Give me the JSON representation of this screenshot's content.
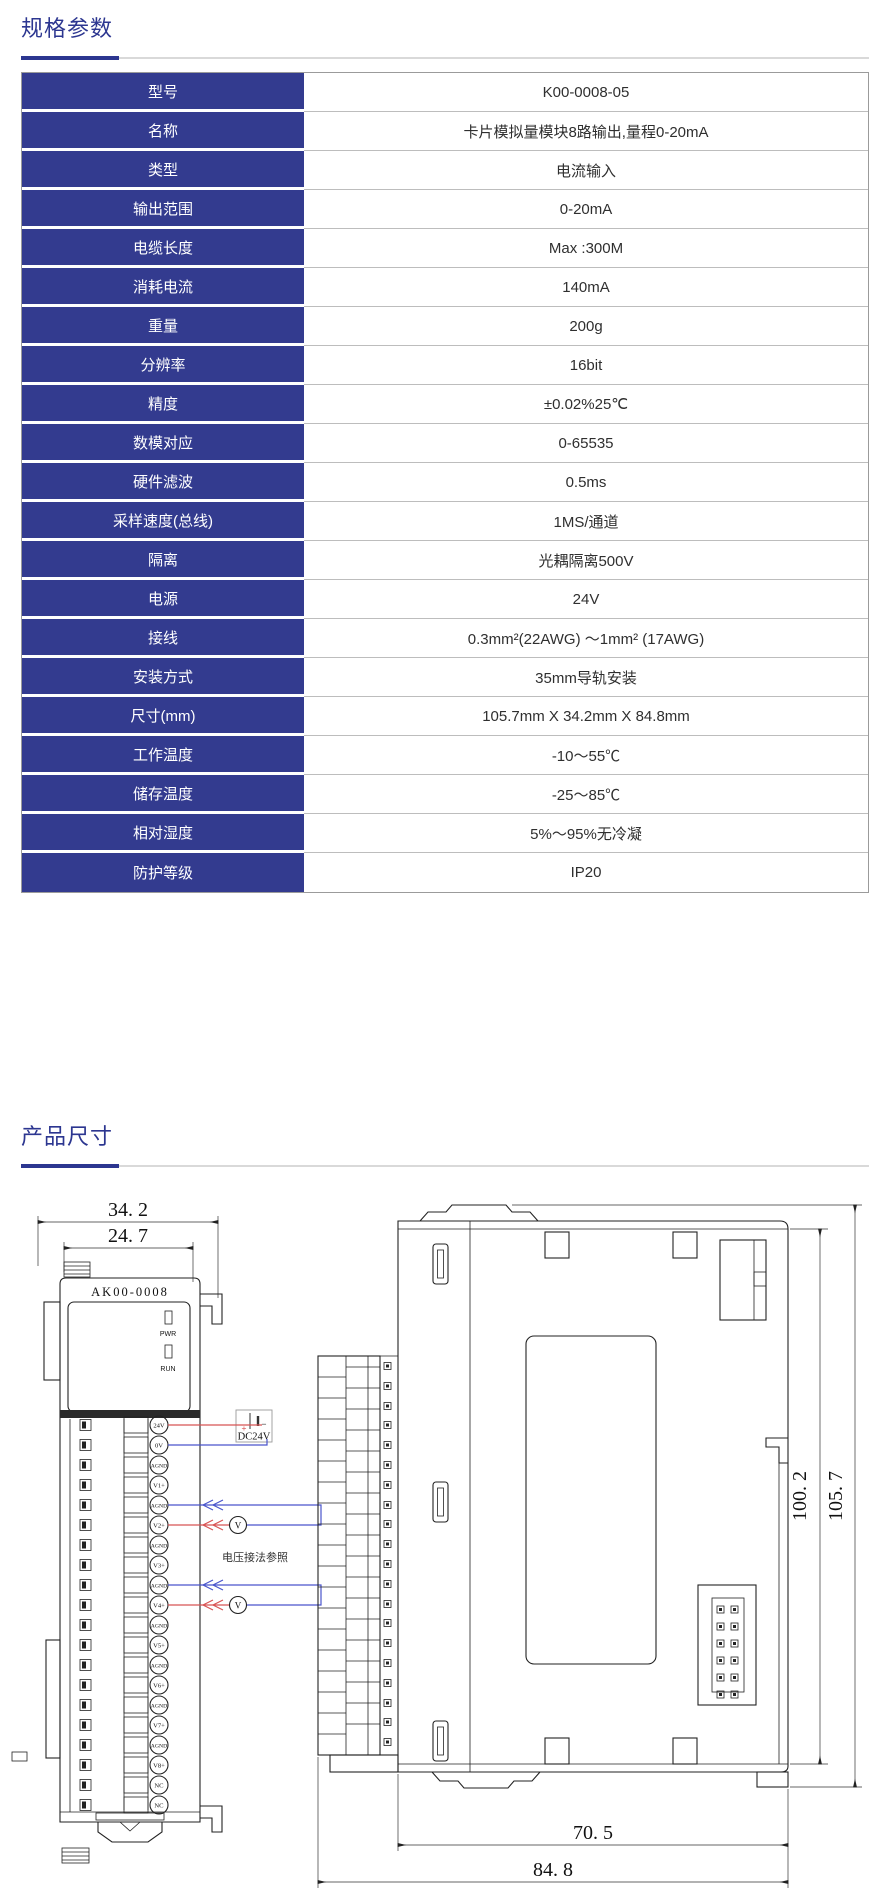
{
  "specs": {
    "title": "规格参数",
    "rows": [
      {
        "label": "型号",
        "value": "K00-0008-05"
      },
      {
        "label": "名称",
        "value": "卡片模拟量模块8路输出,量程0-20mA"
      },
      {
        "label": "类型",
        "value": "电流输入"
      },
      {
        "label": "输出范围",
        "value": "0-20mA"
      },
      {
        "label": "电缆长度",
        "value": "Max :300M"
      },
      {
        "label": "消耗电流",
        "value": "140mA"
      },
      {
        "label": "重量",
        "value": "200g"
      },
      {
        "label": "分辨率",
        "value": "16bit"
      },
      {
        "label": "精度",
        "value": "±0.02%25℃"
      },
      {
        "label": "数模对应",
        "value": "0-65535"
      },
      {
        "label": "硬件滤波",
        "value": "0.5ms"
      },
      {
        "label": "采样速度(总线)",
        "value": "1MS/通道"
      },
      {
        "label": "隔离",
        "value": "光耦隔离500V"
      },
      {
        "label": "电源",
        "value": "24V"
      },
      {
        "label": "接线",
        "value": "0.3mm²(22AWG) ～1mm² (17AWG)"
      },
      {
        "label": "安装方式",
        "value": "35mm导轨安装"
      },
      {
        "label": "尺寸(mm)",
        "value": "105.7mm X 34.2mm X 84.8mm"
      },
      {
        "label": "工作温度",
        "value": "-10～55℃"
      },
      {
        "label": "储存温度",
        "value": "-25～85℃"
      },
      {
        "label": "相对湿度",
        "value": "5%～95%无冷凝"
      },
      {
        "label": "防护等级",
        "value": "IP20"
      }
    ]
  },
  "dims": {
    "title": "产品尺寸",
    "front": {
      "width_outer": "34. 2",
      "width_inner": "24. 7",
      "model": "AK00-0008",
      "led_pwr": "PWR",
      "led_run": "RUN",
      "terminals": [
        "24V",
        "0V",
        "AGND",
        "V1+",
        "AGND",
        "V2+",
        "AGND",
        "V3+",
        "AGND",
        "V4+",
        "AGND",
        "V5+",
        "AGND",
        "V6+",
        "AGND",
        "V7+",
        "AGND",
        "V8+",
        "NC",
        "NC"
      ],
      "supply": {
        "label": "DC24V",
        "plus": "+",
        "minus": "−"
      },
      "meter": "V",
      "note": "电压接法参照"
    },
    "side": {
      "height_inner": "100. 2",
      "height_outer": "105. 7",
      "depth_inner": "70. 5",
      "depth_outer": "84. 8"
    },
    "colors": {
      "wire_positive": "#d85353",
      "wire_negative": "#4a55cc"
    }
  },
  "theme": {
    "accent": "#2c3690",
    "table_label_bg": "#333b8f"
  }
}
